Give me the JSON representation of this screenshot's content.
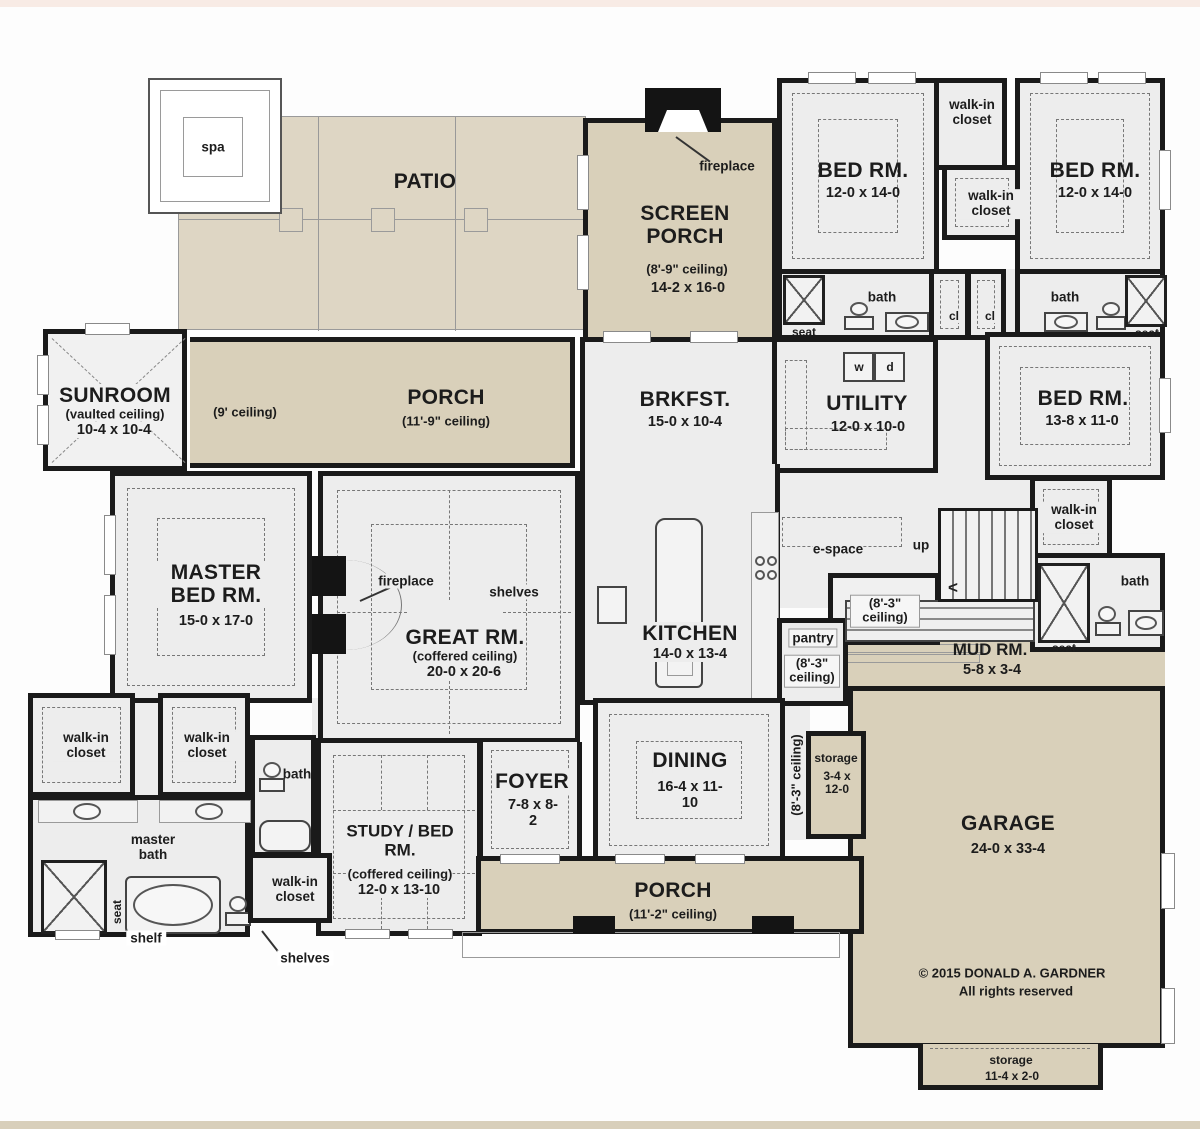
{
  "common": {
    "spa": "spa",
    "walk_in": "walk-in closet",
    "bath": "bath",
    "seat": "seat",
    "cl": "cl",
    "fireplace": "fireplace",
    "shelves": "shelves",
    "shelf": "shelf",
    "storage": "storage",
    "up": "up",
    "arrow": "<",
    "e_space": "e-space",
    "master_bath": "master bath",
    "washer": "w",
    "dryer": "d",
    "ceiling_8_3": "(8'-3\" ceiling)"
  },
  "outdoor": {
    "patio": "PATIO",
    "rear_ceiling": "(9' ceiling)",
    "rear_porch": {
      "name": "PORCH",
      "ceiling": "(11'-9\" ceiling)"
    },
    "front_porch": {
      "name": "PORCH",
      "ceiling": "(11'-2\" ceiling)"
    },
    "screen_porch": {
      "name": "SCREEN PORCH",
      "ceiling": "(8'-9\" ceiling)",
      "dims": "14-2 x 16-0"
    },
    "garage": {
      "name": "GARAGE",
      "dims": "24-0 x 33-4"
    },
    "mud": {
      "name": "MUD RM.",
      "dims": "5-8 x 3-4"
    },
    "storage_side": {
      "dims": "3-4 x 12-0"
    },
    "storage_bottom": {
      "dims": "11-4 x 2-0"
    }
  },
  "rooms": {
    "bed_tl": {
      "name": "BED RM.",
      "dims": "12-0 x 14-0"
    },
    "bed_tr": {
      "name": "BED RM.",
      "dims": "12-0 x 14-0"
    },
    "bed_r": {
      "name": "BED RM.",
      "dims": "13-8 x 11-0"
    },
    "sunroom": {
      "name": "SUNROOM",
      "ceiling": "(vaulted ceiling)",
      "dims": "10-4 x 10-4"
    },
    "brkfst": {
      "name": "BRKFST.",
      "dims": "15-0 x 10-4"
    },
    "utility": {
      "name": "UTILITY",
      "dims": "12-0 x 10-0"
    },
    "master": {
      "name": "MASTER BED RM.",
      "dims": "15-0 x 17-0"
    },
    "great": {
      "name": "GREAT RM.",
      "ceiling": "(coffered ceiling)",
      "dims": "20-0 x 20-6"
    },
    "kitchen": {
      "name": "KITCHEN",
      "dims": "14-0 x 13-4"
    },
    "pantry": {
      "name": "pantry"
    },
    "dining": {
      "name": "DINING",
      "dims": "16-4 x 11-10"
    },
    "foyer": {
      "name": "FOYER",
      "dims": "7-8 x 8-2"
    },
    "study": {
      "name": "STUDY / BED RM.",
      "ceiling": "(coffered ceiling)",
      "dims": "12-0 x 13-10"
    }
  },
  "footer": {
    "copyright": "© 2015 DONALD A. GARDNER",
    "rights": "All rights reserved"
  }
}
